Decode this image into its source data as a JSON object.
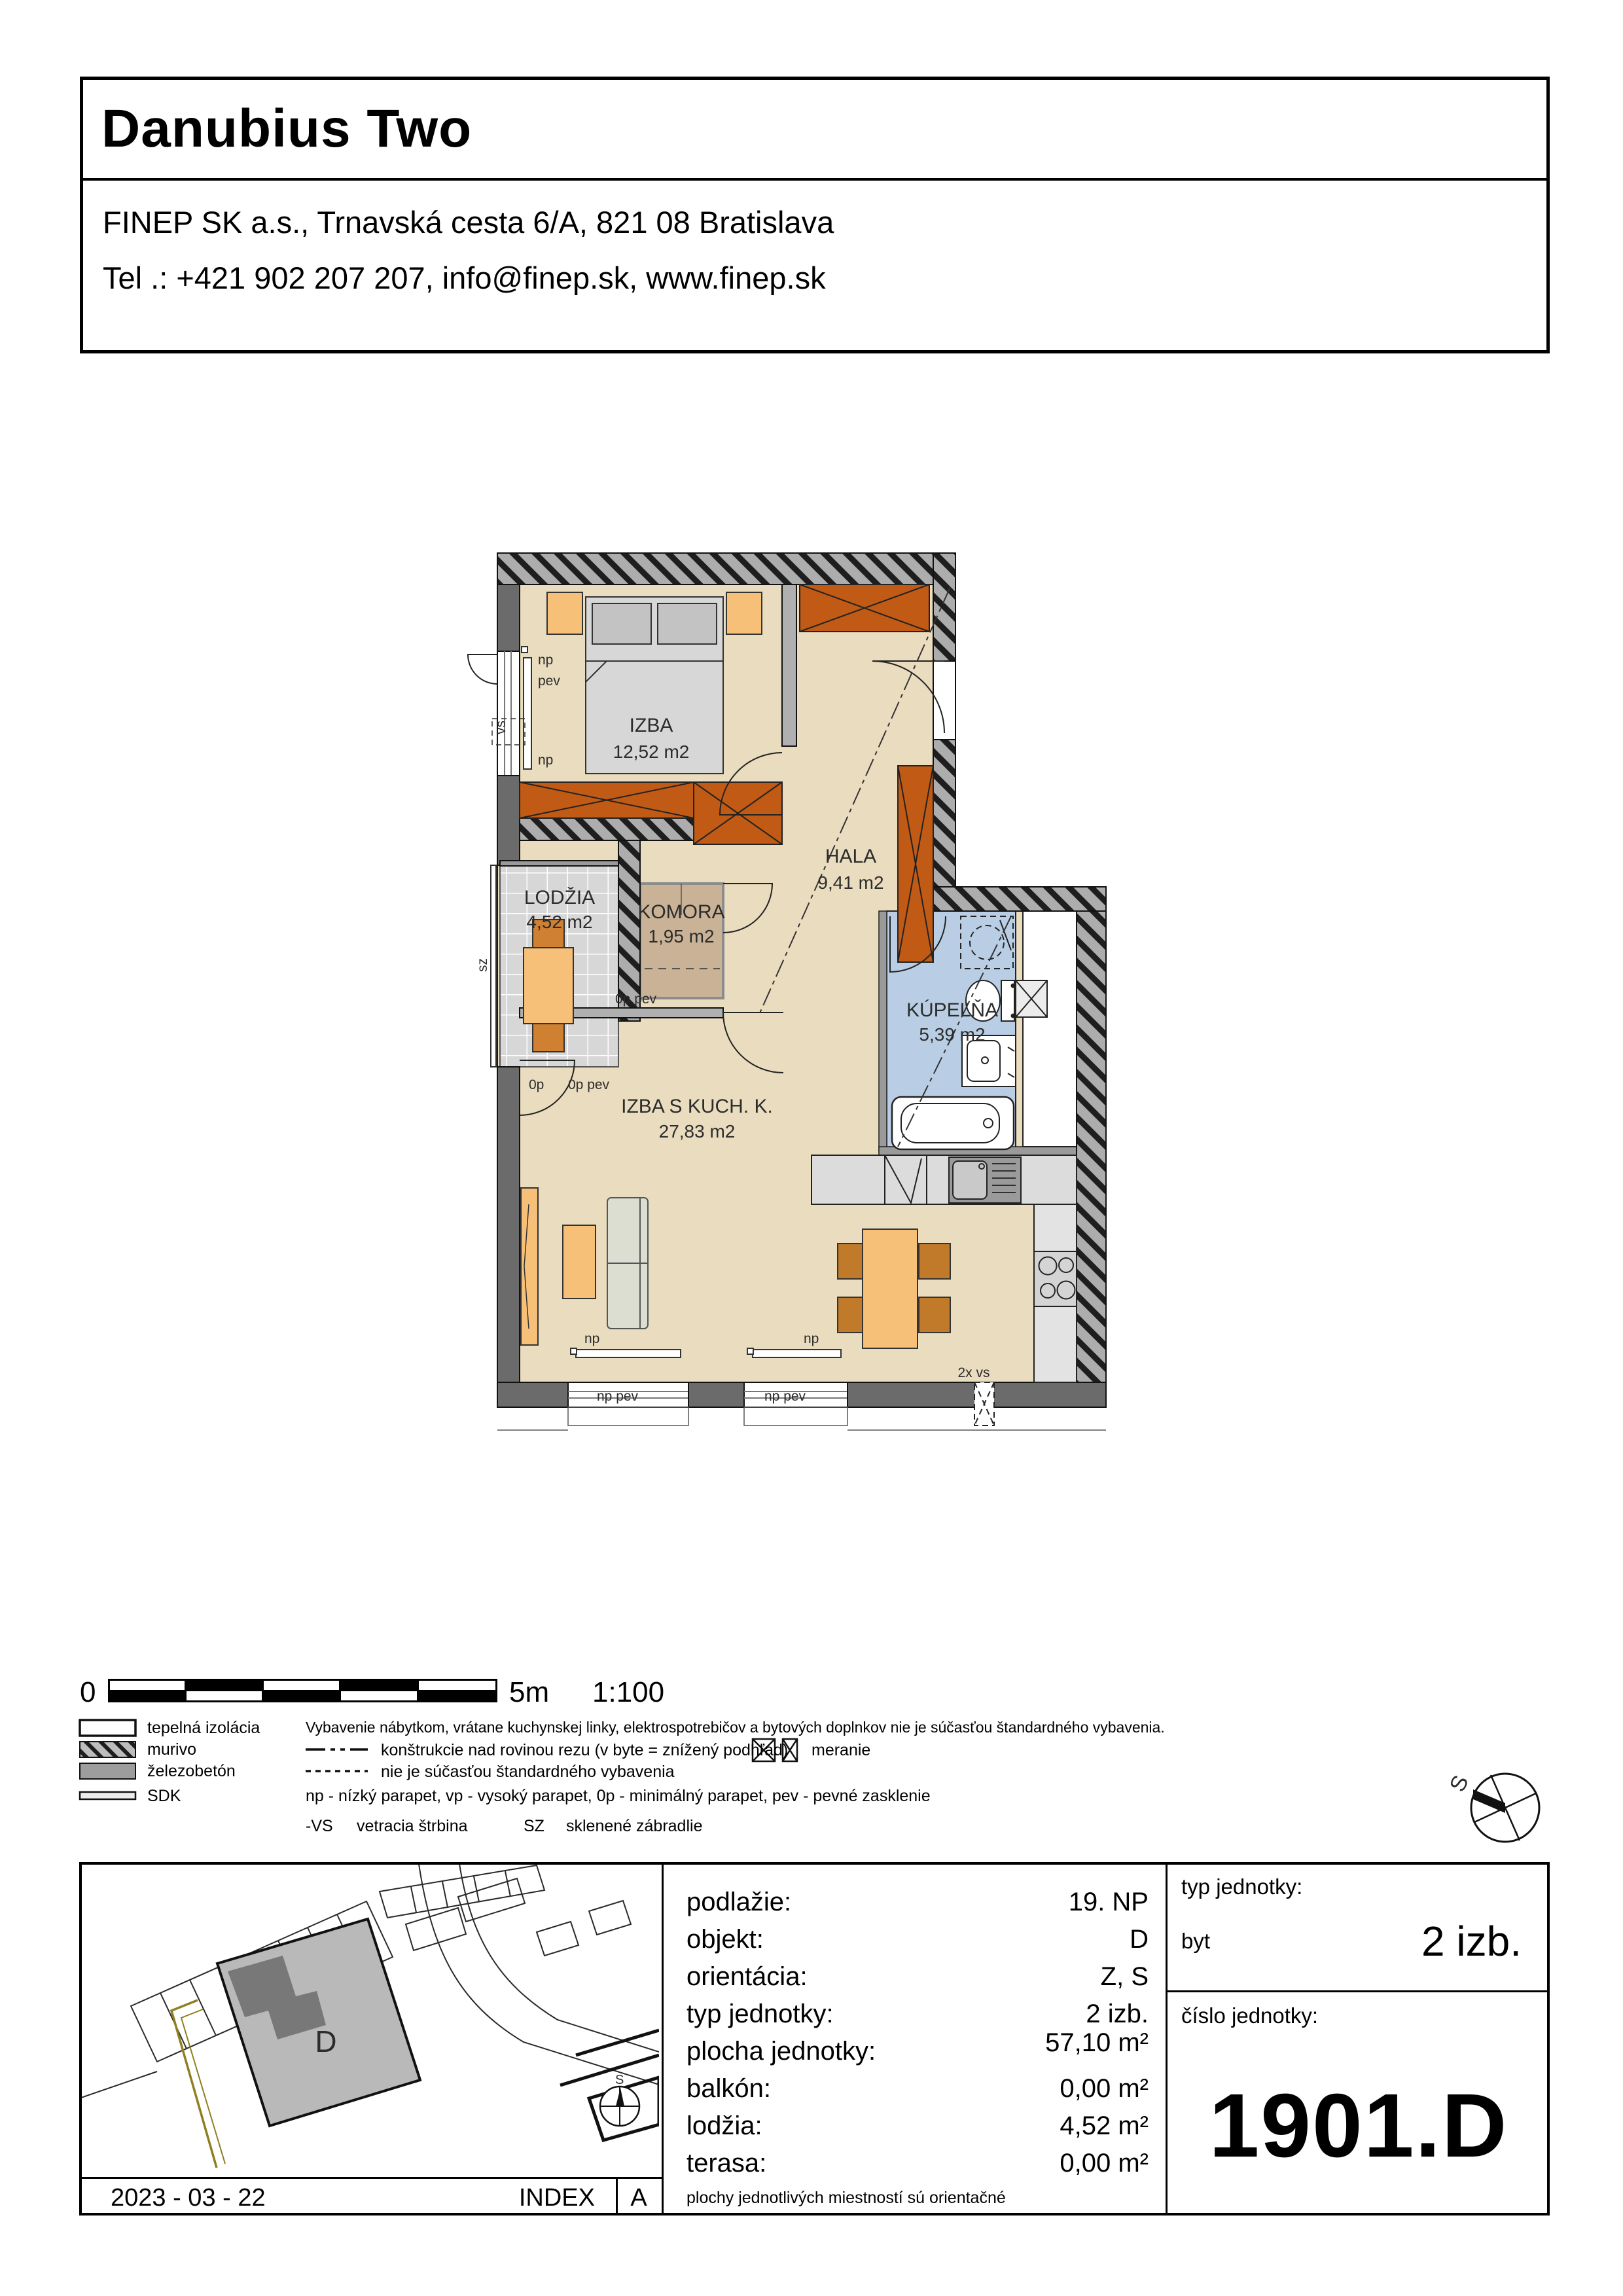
{
  "header": {
    "title": "Danubius Two",
    "address_line1": "FINEP SK a.s., Trnavská cesta 6/A, 821 08 Bratislava",
    "address_line2": "Tel .: +421 902 207 207, info@finep.sk, www.finep.sk"
  },
  "plan": {
    "rooms": {
      "izba": {
        "name": "IZBA",
        "area": "12,52 m2"
      },
      "hala": {
        "name": "HALA",
        "area": "9,41 m2"
      },
      "lodzia": {
        "name": "LODŽIA",
        "area": "4,52 m2"
      },
      "komora": {
        "name": "KOMORA",
        "area": "1,95 m2"
      },
      "kupelna": {
        "name": "KÚPEĽŇA",
        "area": "5,39 m2"
      },
      "obyvacka": {
        "name": "IZBA S KUCH. K.",
        "area": "27,83 m2"
      }
    },
    "annotations": {
      "np": "np",
      "pev": "pev",
      "np_pev": "np pev",
      "op": "0p",
      "op_pev": "0p pev",
      "vs": "vs",
      "sz": "sz",
      "vs2x": "2x vs"
    }
  },
  "scalebar": {
    "zero": "0",
    "max": "5m",
    "ratio": "1:100"
  },
  "legend": {
    "materials": [
      {
        "label": "tepelná izolácia"
      },
      {
        "label": "murivo"
      },
      {
        "label": "železobetón"
      },
      {
        "label": "SDK"
      }
    ],
    "note_equipment": "Vybavenie nábytkom, vrátane kuchynskej linky, elektrospotrebičov a bytových doplnkov nie je súčasťou štandardného vybavenia.",
    "note_dashdot": "konštrukcie nad rovinou rezu (v byte = znížený podhľad)",
    "note_meranie": "meranie",
    "note_dashed": "nie je súčasťou štandardného vybavenia",
    "note_parapet": "np - nízký parapet, vp - vysoký parapet, 0p - minimálný parapet, pev - pevné zasklenie",
    "vs_abbr": "-VS",
    "vs_label": "vetracia štrbina",
    "sz_abbr": "SZ",
    "sz_label": "sklenené zábradlie"
  },
  "info_table": {
    "rows": [
      {
        "label": "podlažie:",
        "value": "19. NP"
      },
      {
        "label": "objekt:",
        "value": "D"
      },
      {
        "label": "orientácia:",
        "value": "Z, S"
      },
      {
        "label": "typ jednotky:",
        "value": "2 izb."
      },
      {
        "label": "plocha jednotky:",
        "value": "57,10 m²"
      },
      {
        "label": "balkón:",
        "value": "0,00 m²"
      },
      {
        "label": "lodžia:",
        "value": "4,52 m²"
      },
      {
        "label": "terasa:",
        "value": "0,00 m²"
      }
    ],
    "note": "plochy jednotlivých miestností sú orientačné"
  },
  "unit_panel": {
    "type_label": "typ jednotky:",
    "type_category": "byt",
    "type_value": "2 izb.",
    "number_label": "číslo jednotky:",
    "number_value": "1901.D"
  },
  "footer": {
    "date": "2023 - 03 - 22",
    "index_label": "INDEX",
    "index_value": "A"
  },
  "site_map": {
    "building_label": "D",
    "compass_label": "S"
  },
  "compass": {
    "label": "S"
  },
  "colors": {
    "floor": "#EADCBF",
    "wall": "#6B6B6B",
    "wardrobe": "#C05A14",
    "furniture_orange": "#F7C078",
    "bath_blue": "#B9CEE4",
    "komora_brown": "#C9B295"
  }
}
